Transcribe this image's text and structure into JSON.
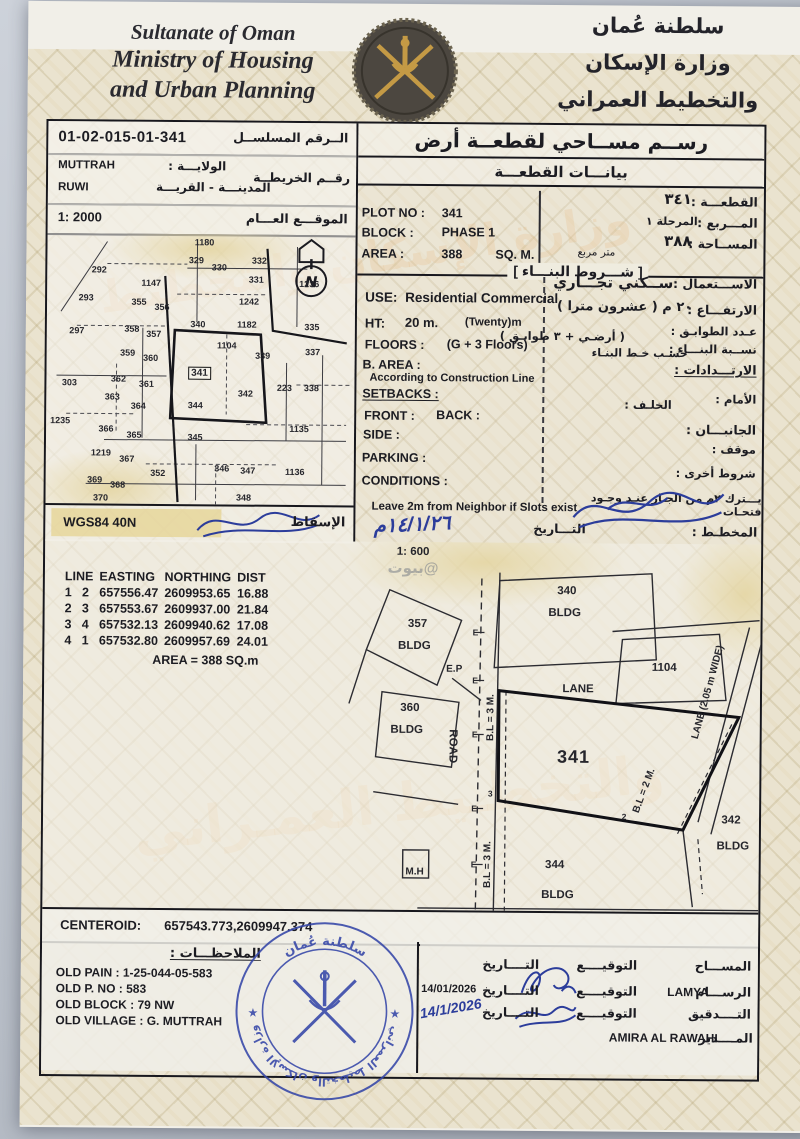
{
  "header": {
    "en_line1": "Sultanate of Oman",
    "en_line2": "Ministry of Housing",
    "en_line3": "and Urban Planning",
    "ar_line1": "سلطنة عُمان",
    "ar_line2": "وزارة الإسكان",
    "ar_line3": "والتخطيط العمراني"
  },
  "watermarks": {
    "security": "وزارة الإسكان والتخطيط",
    "security2": "والتخطـيط العمـراني",
    "listing": "بيوت@"
  },
  "ref": {
    "serial": "01-02-015-01-341",
    "serial_label_ar": "الــرقم المسلســل",
    "map_no_label_ar": "رقــم الخريطــة",
    "wilaya_label_ar": "الولايـــة :",
    "wilaya": "MUTTRAH",
    "town_label_ar": "المدينـــة - القريـــة",
    "town": "RUWI",
    "location_label_ar": "الموقـــع العـــام",
    "scale": "1: 2000"
  },
  "survey": {
    "title_ar": "رســم مســاحي لقطعــة أرض",
    "subtitle_ar": "بيانـــات القطعـــة"
  },
  "plot": {
    "plot_no_label": "PLOT NO :",
    "plot_no": "341",
    "plot_ar_label": "القطعـــة :",
    "plot_ar": "٣٤١",
    "block_label": "BLOCK :",
    "block": "PHASE 1",
    "block_ar_label": "المـــربع :",
    "block_ar": "المرحلة ١",
    "area_label": "AREA :",
    "area": "388",
    "area_unit": "SQ. M.",
    "area_ar_label": "المســاحة :",
    "area_ar": "٣٨٨",
    "area_unit_ar": "متر مربع"
  },
  "conditions": {
    "title_ar": "[ شـــروط البنـــاء ]",
    "use_label": "USE:",
    "use": "Residential Commercial",
    "use_ar_label": "الاســـتعمال :",
    "use_ar": "ســكني تجـــاري",
    "ht_label": "HT:",
    "ht": "20 m.",
    "ht_note": "(Twenty)m",
    "ht_ar_label": "الارتفـــاع :",
    "ht_ar": "٢٠ م ( عشرون مترا )",
    "floors_label": "FLOORS :",
    "floors": "(G + 3 Floors)",
    "floors_ar_label": "عـدد الطوابـق :",
    "floors_ar": "( أرضـي + ٣ طوابـق )",
    "barea_label": "B. AREA :",
    "barea": "According to Construction Line",
    "barea_ar_label": "نســبة البنـــاء :",
    "barea_ar": "حسـب خـط البنـاء",
    "setbacks_label": "SETBACKS :",
    "setbacks_ar_label": "الارتـــدادات :",
    "front_label": "FRONT :",
    "back_label": "BACK :",
    "front_ar_label": "الأمام :",
    "back_ar_label": "الخلـف :",
    "side_label": "SIDE :",
    "side_ar_label": "الجانبـــان :",
    "parking_label": "PARKING :",
    "parking_ar_label": "موقف :",
    "conditions_label": "CONDITIONS :",
    "conditions_ar_label": "شروط أخرى :",
    "note_en": "Leave 2m from Neighbor if Slots exist",
    "note_ar": "يـــترك ٢م من الجـار عنـد وجـود فتحـات",
    "date_label_ar": "التـــاريخ",
    "date_handwritten": "١٤/١/٢٦م",
    "planner_label_ar": "المخطـط :"
  },
  "map": {
    "wgs": "WGS84 40N",
    "projection_label_ar": "الإسقاط",
    "north": "N",
    "plots": [
      {
        "n": "1180",
        "x": 157,
        "y": 8
      },
      {
        "n": "292",
        "x": 52,
        "y": 36
      },
      {
        "n": "1147",
        "x": 104,
        "y": 49
      },
      {
        "n": "329",
        "x": 149,
        "y": 26
      },
      {
        "n": "330",
        "x": 172,
        "y": 33
      },
      {
        "n": "332",
        "x": 212,
        "y": 26
      },
      {
        "n": "331",
        "x": 209,
        "y": 45
      },
      {
        "n": "1236",
        "x": 262,
        "y": 49
      },
      {
        "n": "293",
        "x": 39,
        "y": 64
      },
      {
        "n": "355",
        "x": 92,
        "y": 68
      },
      {
        "n": "356",
        "x": 115,
        "y": 73
      },
      {
        "n": "1242",
        "x": 202,
        "y": 67
      },
      {
        "n": "297",
        "x": 30,
        "y": 97
      },
      {
        "n": "358",
        "x": 85,
        "y": 95
      },
      {
        "n": "357",
        "x": 107,
        "y": 100
      },
      {
        "n": "340",
        "x": 151,
        "y": 90
      },
      {
        "n": "1182",
        "x": 200,
        "y": 90
      },
      {
        "n": "335",
        "x": 265,
        "y": 92
      },
      {
        "n": "359",
        "x": 81,
        "y": 119
      },
      {
        "n": "360",
        "x": 104,
        "y": 124
      },
      {
        "n": "1104",
        "x": 180,
        "y": 111
      },
      {
        "n": "339",
        "x": 216,
        "y": 121
      },
      {
        "n": "337",
        "x": 266,
        "y": 117
      },
      {
        "n": "303",
        "x": 23,
        "y": 149
      },
      {
        "n": "362",
        "x": 72,
        "y": 145
      },
      {
        "n": "361",
        "x": 100,
        "y": 150
      },
      {
        "n": "341",
        "x": 153,
        "y": 139,
        "b": 1
      },
      {
        "n": "363",
        "x": 66,
        "y": 163
      },
      {
        "n": "364",
        "x": 92,
        "y": 172
      },
      {
        "n": "344",
        "x": 149,
        "y": 171
      },
      {
        "n": "342",
        "x": 199,
        "y": 159
      },
      {
        "n": "223",
        "x": 238,
        "y": 153
      },
      {
        "n": "338",
        "x": 265,
        "y": 153
      },
      {
        "n": "1235",
        "x": 14,
        "y": 187
      },
      {
        "n": "366",
        "x": 60,
        "y": 195
      },
      {
        "n": "365",
        "x": 88,
        "y": 201
      },
      {
        "n": "345",
        "x": 149,
        "y": 203
      },
      {
        "n": "1135",
        "x": 253,
        "y": 194
      },
      {
        "n": "1219",
        "x": 55,
        "y": 219
      },
      {
        "n": "367",
        "x": 81,
        "y": 225
      },
      {
        "n": "352",
        "x": 112,
        "y": 239
      },
      {
        "n": "346",
        "x": 176,
        "y": 234
      },
      {
        "n": "347",
        "x": 202,
        "y": 236
      },
      {
        "n": "1136",
        "x": 249,
        "y": 237
      },
      {
        "n": "369",
        "x": 49,
        "y": 246
      },
      {
        "n": "368",
        "x": 72,
        "y": 251
      },
      {
        "n": "370",
        "x": 55,
        "y": 264
      },
      {
        "n": "348",
        "x": 198,
        "y": 263
      }
    ]
  },
  "plan": {
    "scale": "1: 600",
    "table": {
      "h_line": "LINE",
      "h_easting": "EASTING",
      "h_northing": "NORTHING",
      "h_dist": "DIST",
      "rows": [
        [
          "1",
          "2",
          "657556.47",
          "2609953.65",
          "16.88"
        ],
        [
          "2",
          "3",
          "657553.67",
          "2609937.00",
          "21.84"
        ],
        [
          "3",
          "4",
          "657532.13",
          "2609940.62",
          "17.08"
        ],
        [
          "4",
          "1",
          "657532.80",
          "2609957.69",
          "24.01"
        ]
      ],
      "area_line": "AREA = 388  SQ.m"
    },
    "labels": [
      {
        "t": "1: 600",
        "x": 368,
        "y": 10,
        "c": "md"
      },
      {
        "t": "357",
        "x": 373,
        "y": 82,
        "c": "md"
      },
      {
        "t": "BLDG",
        "x": 370,
        "y": 104,
        "c": "md"
      },
      {
        "t": "E.P",
        "x": 410,
        "y": 127,
        "c": "sm"
      },
      {
        "t": "340",
        "x": 522,
        "y": 48,
        "c": "md"
      },
      {
        "t": "BLDG",
        "x": 520,
        "y": 70,
        "c": "md"
      },
      {
        "t": "1104",
        "x": 620,
        "y": 124,
        "c": "md"
      },
      {
        "t": "LANE",
        "x": 534,
        "y": 146,
        "c": "md"
      },
      {
        "t": "360",
        "x": 366,
        "y": 166,
        "c": "md"
      },
      {
        "t": "BLDG",
        "x": 363,
        "y": 188,
        "c": "md"
      },
      {
        "t": "ROAD",
        "x": 409,
        "y": 204,
        "c": "md",
        "r": 90
      },
      {
        "t": "E",
        "x": 431,
        "y": 90,
        "c": "xs"
      },
      {
        "t": "E",
        "x": 431,
        "y": 138,
        "c": "xs"
      },
      {
        "t": "E",
        "x": 431,
        "y": 192,
        "c": "xs"
      },
      {
        "t": "E",
        "x": 431,
        "y": 266,
        "c": "xs"
      },
      {
        "t": "E",
        "x": 431,
        "y": 322,
        "c": "xs"
      },
      {
        "t": "341",
        "x": 530,
        "y": 214,
        "c": "lg"
      },
      {
        "t": "3",
        "x": 447,
        "y": 251,
        "c": "xs"
      },
      {
        "t": "2",
        "x": 581,
        "y": 273,
        "c": "xs"
      },
      {
        "t": "B.L = 3 M.",
        "x": 447,
        "y": 175,
        "c": "sm",
        "r": -90
      },
      {
        "t": "B.L = 3 M.",
        "x": 445,
        "y": 322,
        "c": "sm",
        "r": -90
      },
      {
        "t": "B.L = 2 M.",
        "x": 601,
        "y": 247,
        "c": "sm",
        "r": -70
      },
      {
        "t": "342",
        "x": 688,
        "y": 276,
        "c": "md"
      },
      {
        "t": "BLDG",
        "x": 690,
        "y": 302,
        "c": "md"
      },
      {
        "t": "344",
        "x": 512,
        "y": 322,
        "c": "md"
      },
      {
        "t": "BLDG",
        "x": 515,
        "y": 352,
        "c": "md"
      },
      {
        "t": "M.H",
        "x": 372,
        "y": 330,
        "c": "sm"
      },
      {
        "t": "LANE (2.05 m WIDE)",
        "x": 664,
        "y": 148,
        "c": "sm",
        "r": -75
      },
      {
        "t": "بيوت@",
        "x": 368,
        "y": 26,
        "c": "wm"
      }
    ]
  },
  "centeroid": {
    "label": "CENTEROID:",
    "value": "657543.773,2609947.374"
  },
  "notes": {
    "title_ar": "الملاحظـــات :",
    "lines": [
      "OLD PAIN : 1-25-044-05-583",
      "OLD P. NO : 583",
      "OLD BLOCK : 79 NW",
      "OLD VILLAGE : G. MUTTRAH"
    ]
  },
  "signoff": {
    "surveyor_label_ar": "المســـاح",
    "drafter_label_ar": "الرســـام",
    "drafter": "LAMYA",
    "check_label_ar": "التــــدقيق",
    "manager_label_ar": "المــــدير",
    "manager": "AMIRA AL RAWAHI",
    "sign_label_ar": "التوقيــــع",
    "date_label_ar": "التــــاريخ",
    "date_printed": "14/01/2026",
    "date_handwritten": "14/1/2026"
  },
  "stamp": {
    "top_ar": "سلطنة عُمان",
    "bottom_ar": "وزارة الإسكان والتخطيط العمراني"
  }
}
